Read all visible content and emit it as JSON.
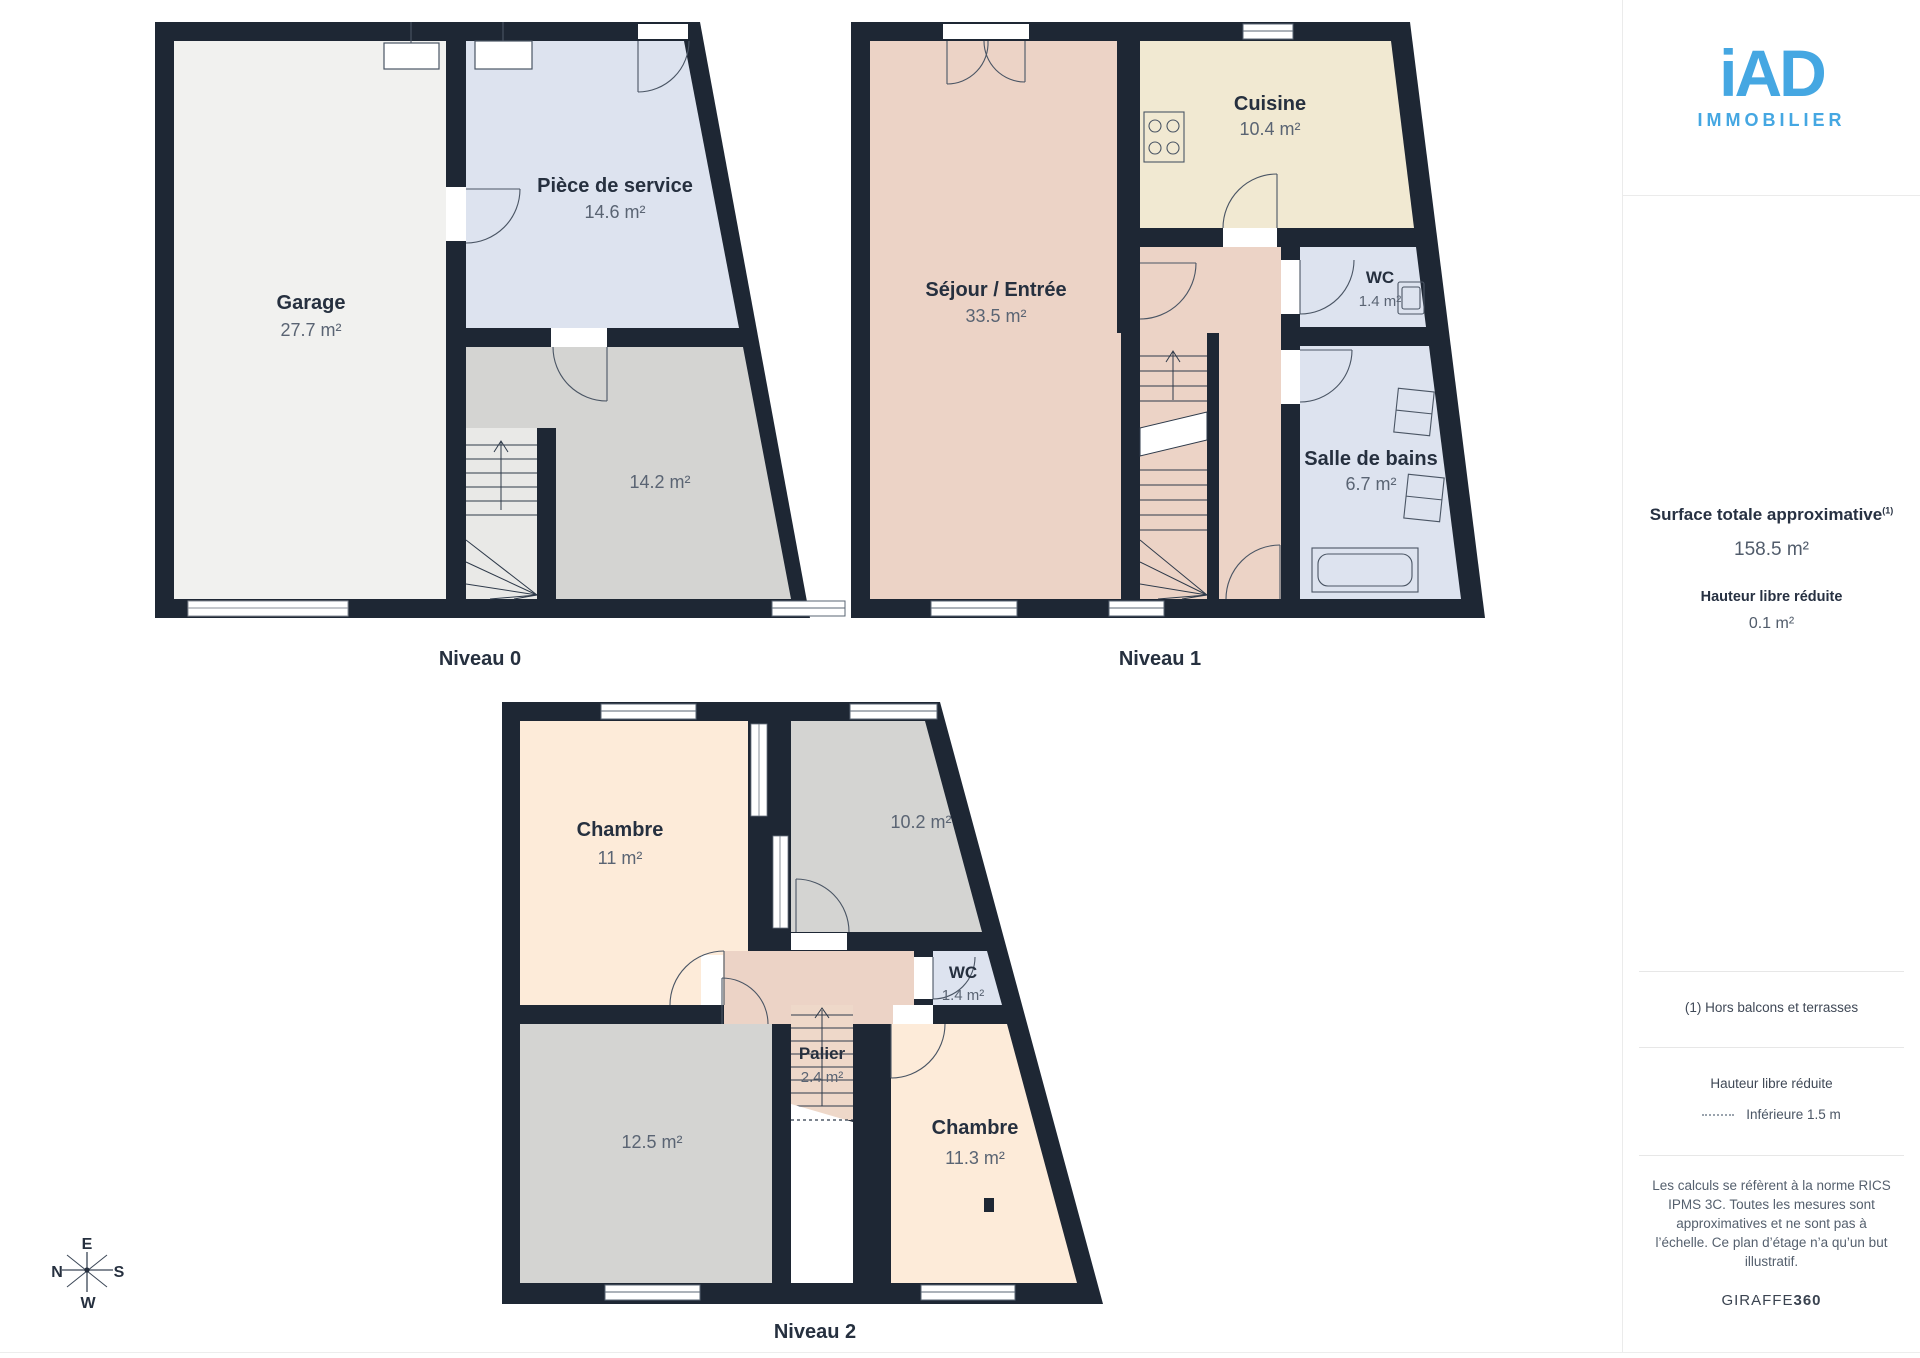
{
  "logo": {
    "brand": "iAD",
    "subtitle": "IMMOBILIER"
  },
  "summary": {
    "title": "Surface totale approximative",
    "title_sup": "(1)",
    "total": "158.5 m²",
    "height_label": "Hauteur libre réduite",
    "height_value": "0.1 m²"
  },
  "notes": {
    "footnote": "(1) Hors balcons et terrasses",
    "legend_title": "Hauteur libre réduite",
    "legend_value": "Inférieure 1.5 m",
    "disclaimer_lines": [
      "Les calculs se réfèrent à la norme RICS",
      "IPMS 3C. Toutes les mesures sont",
      "approximatives et ne sont pas à",
      "l’échelle. Ce plan d’étage n’a qu’un but",
      "illustratif."
    ],
    "credit_regular": "GIRAFFE",
    "credit_bold": "360"
  },
  "levels": [
    {
      "name": "Niveau 0",
      "rooms": [
        {
          "name": "Garage",
          "area": "27.7 m²"
        },
        {
          "name": "Pièce de service",
          "area": "14.6 m²"
        },
        {
          "name": "",
          "area": "14.2 m²"
        }
      ]
    },
    {
      "name": "Niveau 1",
      "rooms": [
        {
          "name": "Séjour / Entrée",
          "area": "33.5 m²"
        },
        {
          "name": "Cuisine",
          "area": "10.4 m²"
        },
        {
          "name": "WC",
          "area": "1.4 m²"
        },
        {
          "name": "Salle de bains",
          "area": "6.7 m²"
        }
      ]
    },
    {
      "name": "Niveau 2",
      "rooms": [
        {
          "name": "Chambre",
          "area": "11 m²"
        },
        {
          "name": "",
          "area": "10.2 m²"
        },
        {
          "name": "WC",
          "area": "1.4 m²"
        },
        {
          "name": "Palier",
          "area": "2.4 m²"
        },
        {
          "name": "",
          "area": "12.5 m²"
        },
        {
          "name": "Chambre",
          "area": "11.3 m²"
        }
      ]
    }
  ],
  "compass": {
    "top": "E",
    "left": "N",
    "right": "S",
    "bottom": "W"
  },
  "colors": {
    "wall": "#1e2734",
    "garage_floor": "#f1f1ef",
    "service_blue": "#dde3ef",
    "neutral_gray": "#d4d4d2",
    "living_salmon": "#ecd3c6",
    "kitchen_cream": "#f1e9d2",
    "bedroom_peach": "#fdebd9",
    "brand_blue": "#45a7e2",
    "text_dark": "#26303f",
    "text_muted": "#5a6473"
  }
}
